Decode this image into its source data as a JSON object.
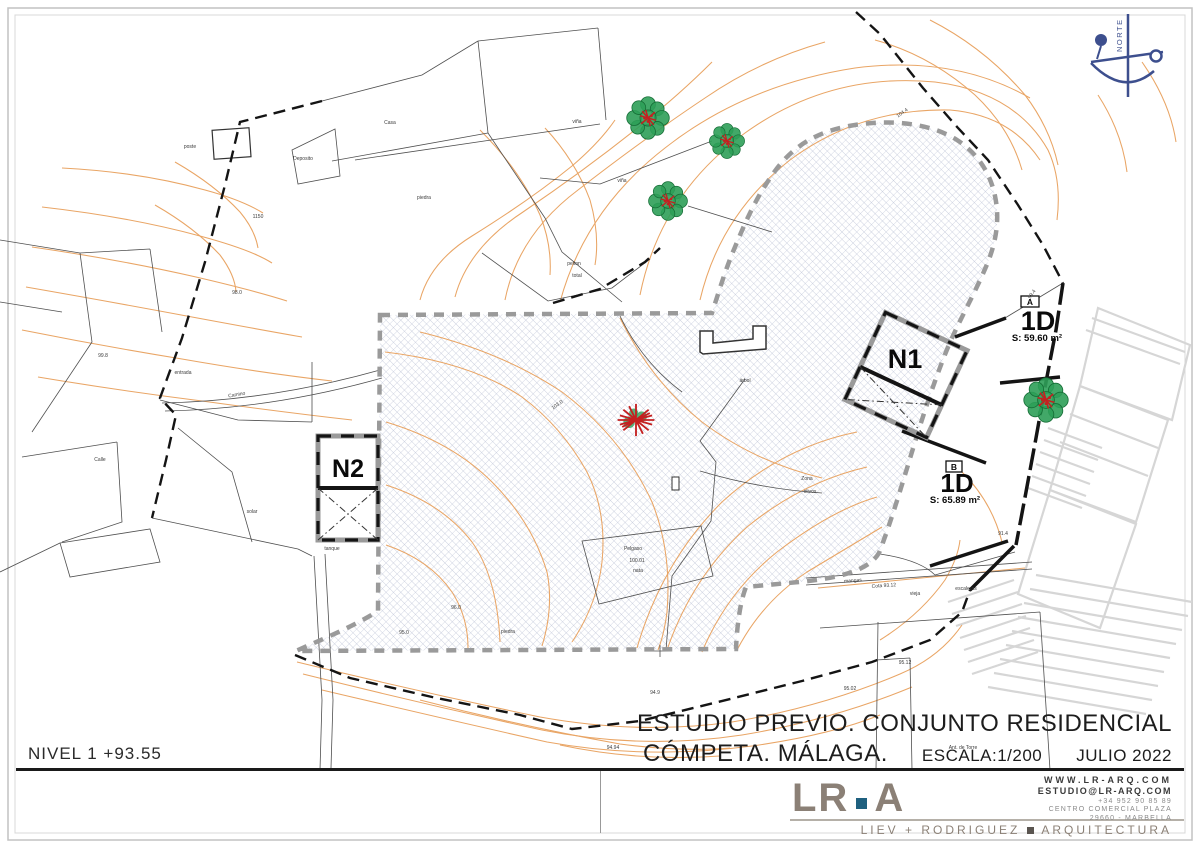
{
  "sheet": {
    "level_label": "NIVEL 1 +93.55",
    "title_line1": "ESTUDIO PREVIO. CONJUNTO RESIDENCIAL",
    "title_line2": "CÓMPETA. MÁLAGA.",
    "scale_label": "ESCALA:1/200",
    "date_label": "JULIO 2022"
  },
  "firm": {
    "logo_lr": "LR",
    "logo_a": "A",
    "website": "WWW.LR-ARQ.COM",
    "email": "ESTUDIO@LR-ARQ.COM",
    "phone": "+34 952 90 85 89",
    "address_line1": "CENTRO COMERCIAL PLAZA",
    "address_line2": "29660 - MARBELLA",
    "tagline": "LIEV + RODRIGUEZ",
    "tagline2": "ARQUITECTURA"
  },
  "compass": {
    "label": "NORTE"
  },
  "plan": {
    "block_labels": {
      "n1": "N1",
      "n2": "N2"
    },
    "units": [
      {
        "tag": "A",
        "name": "1D",
        "area": "S: 59.60 m²"
      },
      {
        "tag": "B",
        "name": "1D",
        "area": "S: 65.89 m²"
      }
    ],
    "labels": [
      "Casa",
      "Deposito",
      "poste",
      "piedra",
      "viña",
      "viña",
      "pelton",
      "total",
      "1150",
      "98.0",
      "99.8",
      "entrada",
      "Camino",
      "Calle",
      "solar",
      "tanque",
      "árbol",
      "Zona",
      "olivos",
      "103.0",
      "104.4",
      "99.4",
      "96.0",
      "95.0",
      "piedra",
      "94.9",
      "94.94",
      "95.12",
      "95.02",
      "91.4",
      "vieja",
      "escaleras",
      "mangas",
      "Cota 93.12",
      "Ant. de Torre",
      "Pelgaso",
      "100.01",
      "nata"
    ]
  },
  "colors": {
    "contour_orange": "#e9a565",
    "hatch_blue_gray": "#b9c0d4",
    "boundary_black": "#141414",
    "neighbor_gray": "#d6d6d6",
    "tree_green": "#2e9e58",
    "tree_red": "#c42020",
    "compass_navy": "#3d4f8e",
    "logo_taupe": "#8b8076",
    "logo_dot_teal": "#1f607f"
  }
}
